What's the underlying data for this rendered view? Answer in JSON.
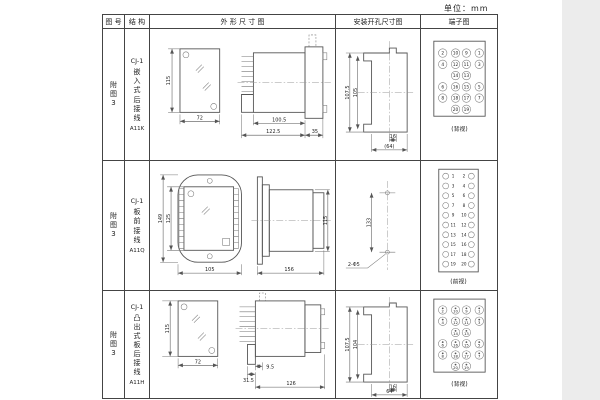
{
  "unit_label": "单位：mm",
  "headers": {
    "fig_no": "图 号",
    "structure": "结 构",
    "outline": "外 形 尺 寸 图",
    "install": "安装开孔尺寸图",
    "terminal": "端子图"
  },
  "rows": [
    {
      "fig_label": "附\n图\n3",
      "type": "CJ-1",
      "mount": "嵌\n入\n式\n后\n接\n线",
      "model": "A11K",
      "outline": {
        "front_height": "115",
        "front_width": "72",
        "dim_a": "100.5",
        "dim_b": "122.5",
        "dim_c": "35"
      },
      "install": {
        "v_outer": "107.5",
        "v_inner": "105",
        "h_inner": "16",
        "h_outer": "(64)"
      },
      "terminal": {
        "caption": "(背视)",
        "layout": "quad",
        "dot": false,
        "grid": [
          [
            "2",
            "10",
            "9",
            "1"
          ],
          [
            "4",
            "12",
            "11",
            "3"
          ],
          [
            null,
            "14",
            "13",
            null
          ],
          [
            "6",
            "16",
            "15",
            "5"
          ],
          [
            "8",
            "18",
            "17",
            "7"
          ],
          [
            null,
            "20",
            "19",
            null
          ]
        ]
      }
    },
    {
      "fig_label": "附\n图\n3",
      "type": "CJ-1",
      "mount": "板\n前\n接\n线",
      "model": "A11Q",
      "outline": {
        "front_height_outer": "149",
        "front_height_inner": "125",
        "front_width": "105",
        "side_length": "156",
        "side_height": "115"
      },
      "install": {
        "v_dim": "133",
        "hole_label": "2-Φ5"
      },
      "terminal": {
        "caption": "(前视)",
        "layout": "pairs",
        "dot": false,
        "grid": [
          [
            "1",
            "2"
          ],
          [
            "3",
            "4"
          ],
          [
            "5",
            "6"
          ],
          [
            "7",
            "8"
          ],
          [
            "9",
            "10"
          ],
          [
            "11",
            "12"
          ],
          [
            "13",
            "14"
          ],
          [
            "15",
            "16"
          ],
          [
            "17",
            "18"
          ],
          [
            "19",
            "20"
          ]
        ]
      }
    },
    {
      "fig_label": "附\n图\n3",
      "type": "CJ-1",
      "mount": "凸\n出\n式\n板\n后\n接\n线",
      "model": "A11H",
      "outline": {
        "front_height": "115",
        "front_width": "72",
        "dim_a": "9.5",
        "dim_b": "31.5",
        "dim_c": "126"
      },
      "install": {
        "v_outer": "107.5",
        "v_inner": "104",
        "h_inner": "16",
        "h_outer": "64"
      },
      "terminal": {
        "caption": "(背视)",
        "layout": "quad",
        "dot": true,
        "grid": [
          [
            "2",
            "10",
            "9",
            "1"
          ],
          [
            "4",
            "12",
            "11",
            "3"
          ],
          [
            null,
            "14",
            "13",
            null
          ],
          [
            "6",
            "16",
            "15",
            "5"
          ],
          [
            "8",
            "18",
            "17",
            "7"
          ],
          [
            null,
            "20",
            "19",
            null
          ]
        ]
      }
    }
  ]
}
